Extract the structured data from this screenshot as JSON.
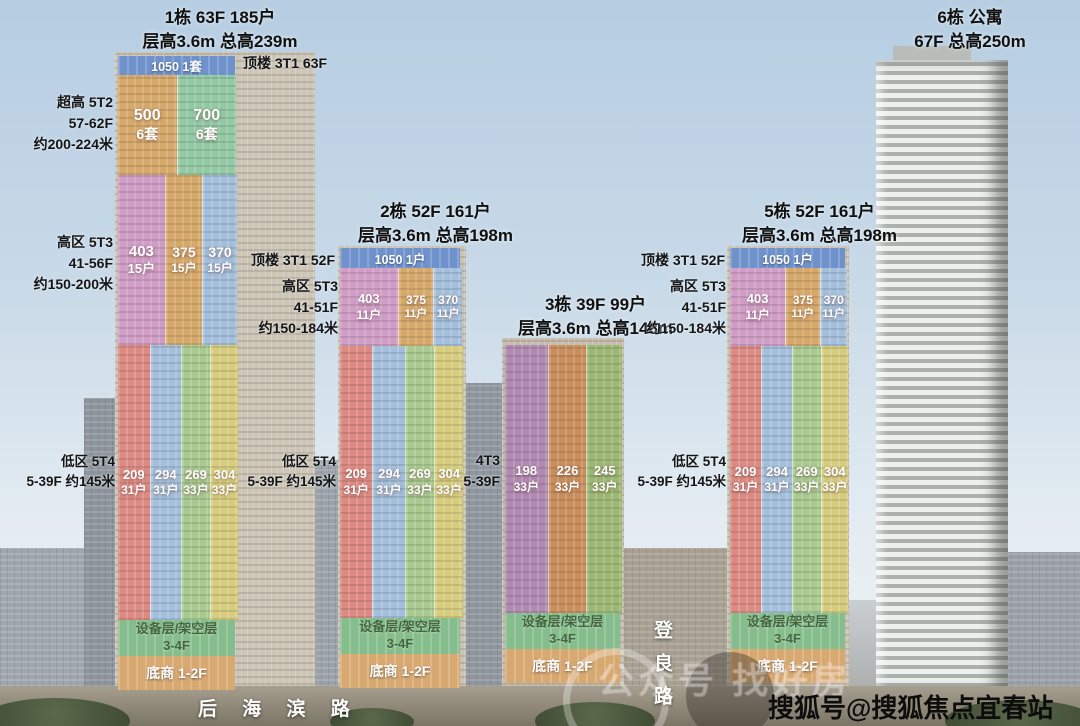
{
  "towers": {
    "t1": {
      "title": [
        "1栋 63F 185户",
        "层高3.6m 总高239m"
      ],
      "roof_label": "顶楼 3T1 63F",
      "top_band": "1050 1套",
      "side_super": [
        "超高 5T2",
        "57-62F",
        "约200-224米"
      ],
      "side_high": [
        "高区 5T3",
        "41-56F",
        "约150-200米"
      ],
      "side_low": [
        "低区 5T4",
        "5-39F 约145米"
      ],
      "super_zones": [
        {
          "area": "500",
          "units": "6套"
        },
        {
          "area": "700",
          "units": "6套"
        }
      ],
      "high_zones": [
        {
          "area": "403",
          "units": "15户"
        },
        {
          "area": "375",
          "units": "15户"
        },
        {
          "area": "370",
          "units": "15户"
        }
      ],
      "low_zones": [
        {
          "area": "209",
          "units": "31户"
        },
        {
          "area": "294",
          "units": "31户"
        },
        {
          "area": "269",
          "units": "33户"
        },
        {
          "area": "304",
          "units": "33户"
        }
      ],
      "equip_band": [
        "设备层/架空层",
        "3-4F"
      ],
      "retail_band": "底商 1-2F"
    },
    "t2": {
      "title": [
        "2栋 52F 161户",
        "层高3.6m 总高198m"
      ],
      "roof_label": "顶楼 3T1 52F",
      "top_band": "1050 1户",
      "side_high": [
        "高区 5T3",
        "41-51F",
        "约150-184米"
      ],
      "side_low": [
        "低区 5T4",
        "5-39F 约145米"
      ],
      "high_zones": [
        {
          "area": "403",
          "units": "11户"
        },
        {
          "area": "375",
          "units": "11户"
        },
        {
          "area": "370",
          "units": "11户"
        }
      ],
      "low_zones": [
        {
          "area": "209",
          "units": "31户"
        },
        {
          "area": "294",
          "units": "31户"
        },
        {
          "area": "269",
          "units": "33户"
        },
        {
          "area": "304",
          "units": "33户"
        }
      ],
      "equip_band": [
        "设备层/架空层",
        "3-4F"
      ],
      "retail_band": "底商 1-2F"
    },
    "t3": {
      "title": [
        "3栋 39F 99户",
        "层高3.6m 总高148m"
      ],
      "side_low": [
        "4T3",
        "5-39F"
      ],
      "zones": [
        {
          "area": "198",
          "units": "33户"
        },
        {
          "area": "226",
          "units": "33户"
        },
        {
          "area": "245",
          "units": "33户"
        }
      ],
      "equip_band": [
        "设备层/架空层",
        "3-4F"
      ],
      "retail_band": "底商 1-2F"
    },
    "t5": {
      "title": [
        "5栋 52F 161户",
        "层高3.6m 总高198m"
      ],
      "roof_label": "顶楼 3T1 52F",
      "top_band": "1050 1户",
      "side_high": [
        "高区 5T3",
        "41-51F",
        "约150-184米"
      ],
      "side_low": [
        "低区 5T4",
        "5-39F 约145米"
      ],
      "high_zones": [
        {
          "area": "403",
          "units": "11户"
        },
        {
          "area": "375",
          "units": "11户"
        },
        {
          "area": "370",
          "units": "11户"
        }
      ],
      "low_zones": [
        {
          "area": "209",
          "units": "31户"
        },
        {
          "area": "294",
          "units": "31户"
        },
        {
          "area": "269",
          "units": "33户"
        },
        {
          "area": "304",
          "units": "33户"
        }
      ],
      "equip_band": [
        "设备层/架空层",
        "3-4F"
      ],
      "retail_band": "底商 1-2F"
    },
    "t6": {
      "title": [
        "6栋 公寓",
        "67F 总高250m"
      ]
    }
  },
  "roads": {
    "houhai": "后 海 滨 路",
    "dengliang": "登良路"
  },
  "watermarks": {
    "channel": "公众号 找好房",
    "sohu": "搜狐号@搜狐焦点宜春站"
  },
  "colors": {
    "top_band_blue": "#6f92cc",
    "zone_orange": "#d6a96b",
    "zone_mint_green": "#93c9a4",
    "zone_pink_purple": "#cf9dc5",
    "zone_blue": "#a3bfdb",
    "zone_red": "#dd8b82",
    "zone_green": "#a8c98f",
    "zone_yellow": "#d6cc7e",
    "zone_purple_t3": "#b18ab2",
    "zone_orange_t3": "#c98e5c",
    "zone_green_t3": "#9cb874",
    "equip_green": "#85bd8d",
    "retail_orange": "#d8a871"
  }
}
